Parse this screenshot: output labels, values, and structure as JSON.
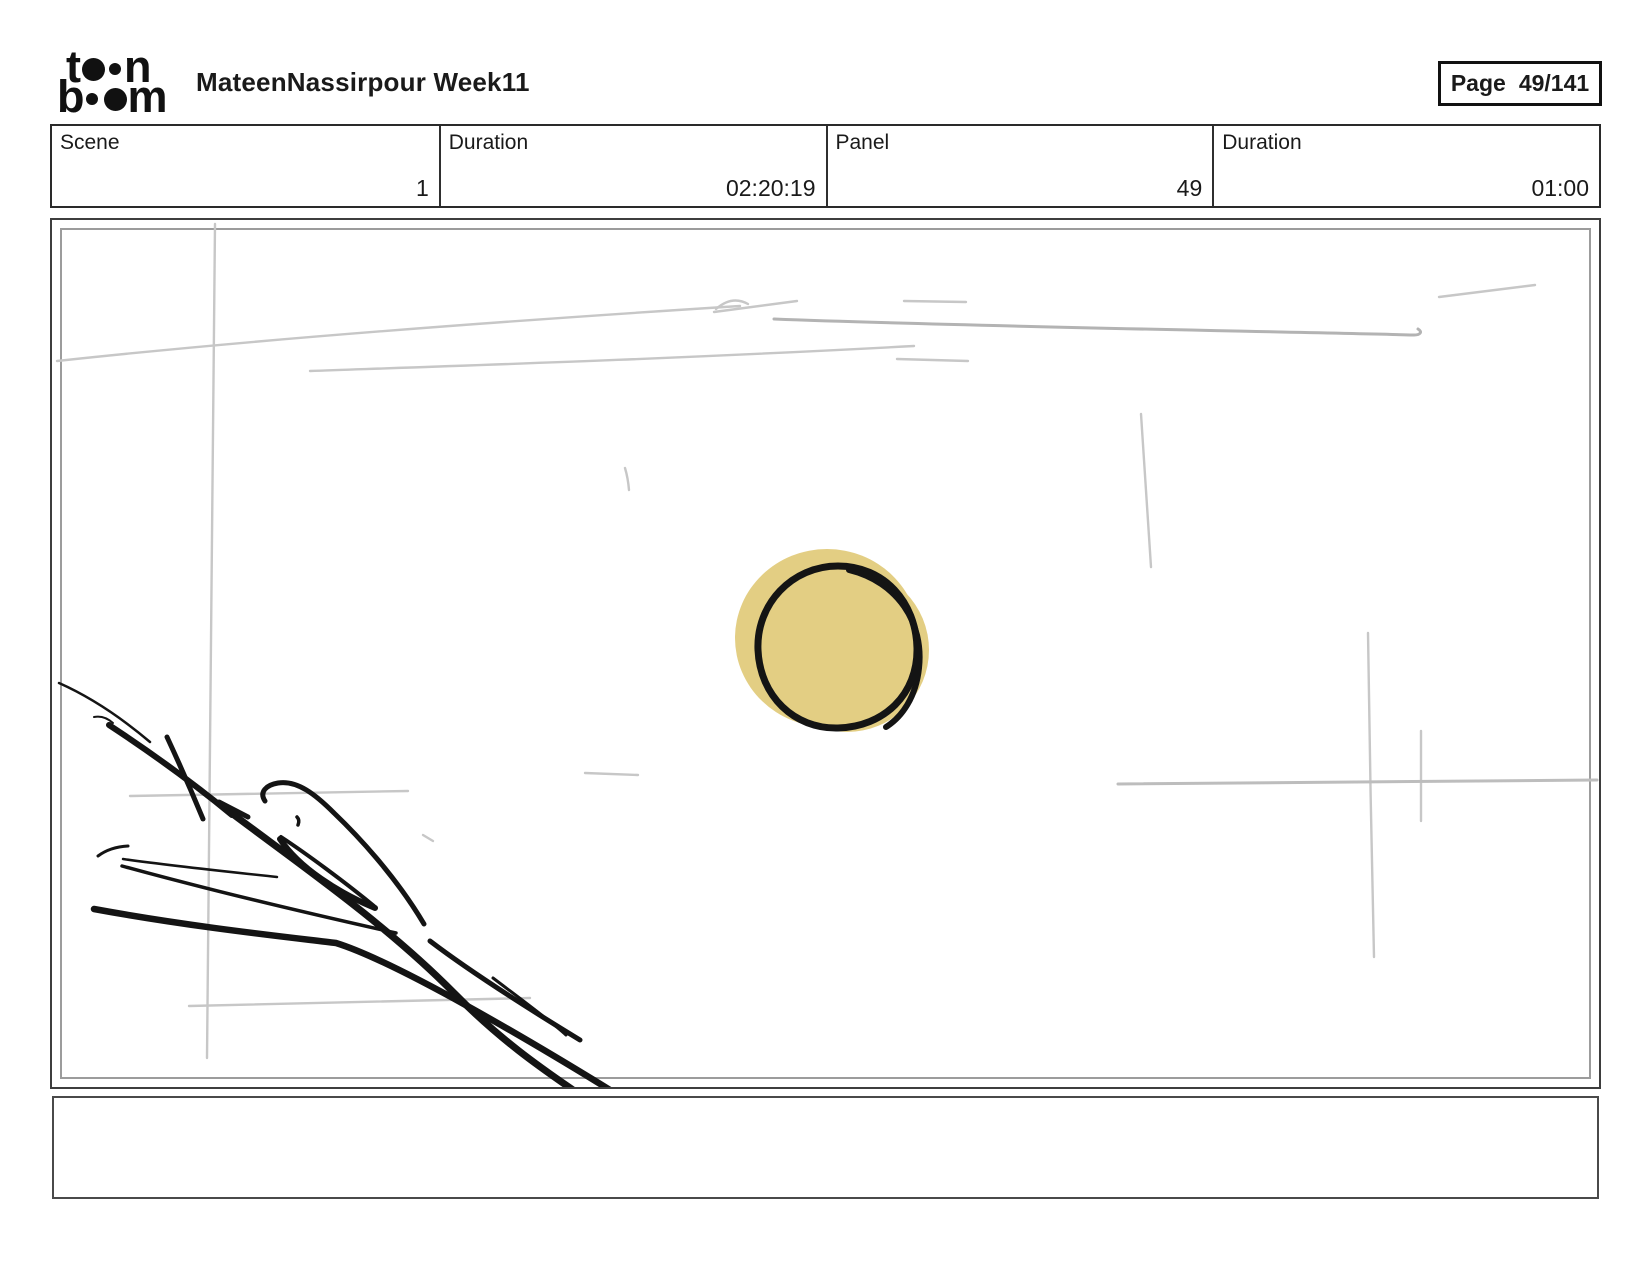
{
  "brand": {
    "logo_alt": "toon boom",
    "logo_word_top": {
      "left": "t",
      "right": "n"
    },
    "logo_word_bottom": {
      "left": "b",
      "right": "m"
    }
  },
  "header": {
    "title": "MateenNassirpour Week11",
    "page_label": "Page",
    "page_value": "49/141"
  },
  "fields": [
    {
      "label": "Scene",
      "value": "1"
    },
    {
      "label": "Duration",
      "value": "02:20:19"
    },
    {
      "label": "Panel",
      "value": "49"
    },
    {
      "label": "Duration",
      "value": "01:00"
    }
  ],
  "storyboard_panel": {
    "caption": "",
    "sketch_description": "rough bird-head gesture sketch lower left, yellow sun circle center, faint gray construction lines"
  },
  "colors": {
    "ink": "#141414",
    "sun_fill": "#e3ce83",
    "sketch_gray": "#c7c7c7",
    "sketch_gray_dark": "#b3b3b3",
    "panel_border": "#3d3d3d",
    "panel_inner_border": "#9c9c9c"
  }
}
